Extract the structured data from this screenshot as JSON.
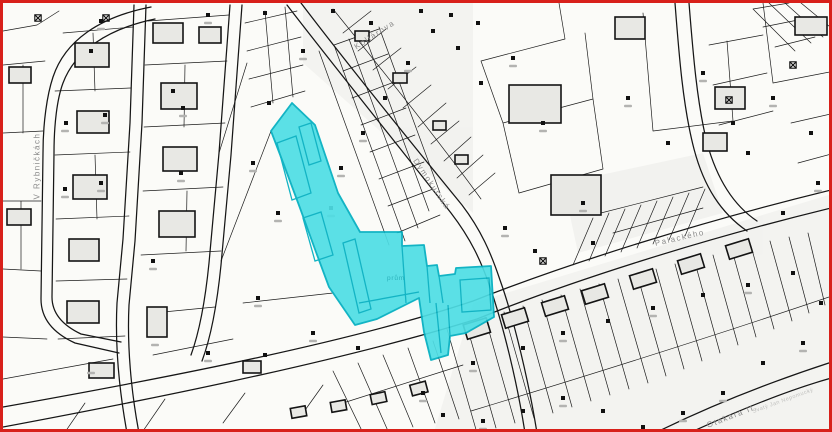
{
  "map": {
    "type_note": "cadastral parcel map with highlighted selection",
    "street_labels": [
      {
        "name": "V Rybničkách"
      },
      {
        "name": "Kollárova"
      },
      {
        "name": "Dymokurská"
      },
      {
        "name": "Palackého"
      },
      {
        "name": "Otakara II."
      }
    ],
    "area_labels": [
      {
        "name": "prům"
      },
      {
        "name": "Svatý Jan Nepomucký"
      }
    ],
    "colors": {
      "frame": "#d8201a",
      "background": "#fbfbf8",
      "parcel_line": "#1a1a1a",
      "building_fill": "#e8e8e4",
      "selection_fill": "#4edee5",
      "selection_stroke": "#00aec0",
      "label_gray": "#8b8b8b"
    }
  }
}
